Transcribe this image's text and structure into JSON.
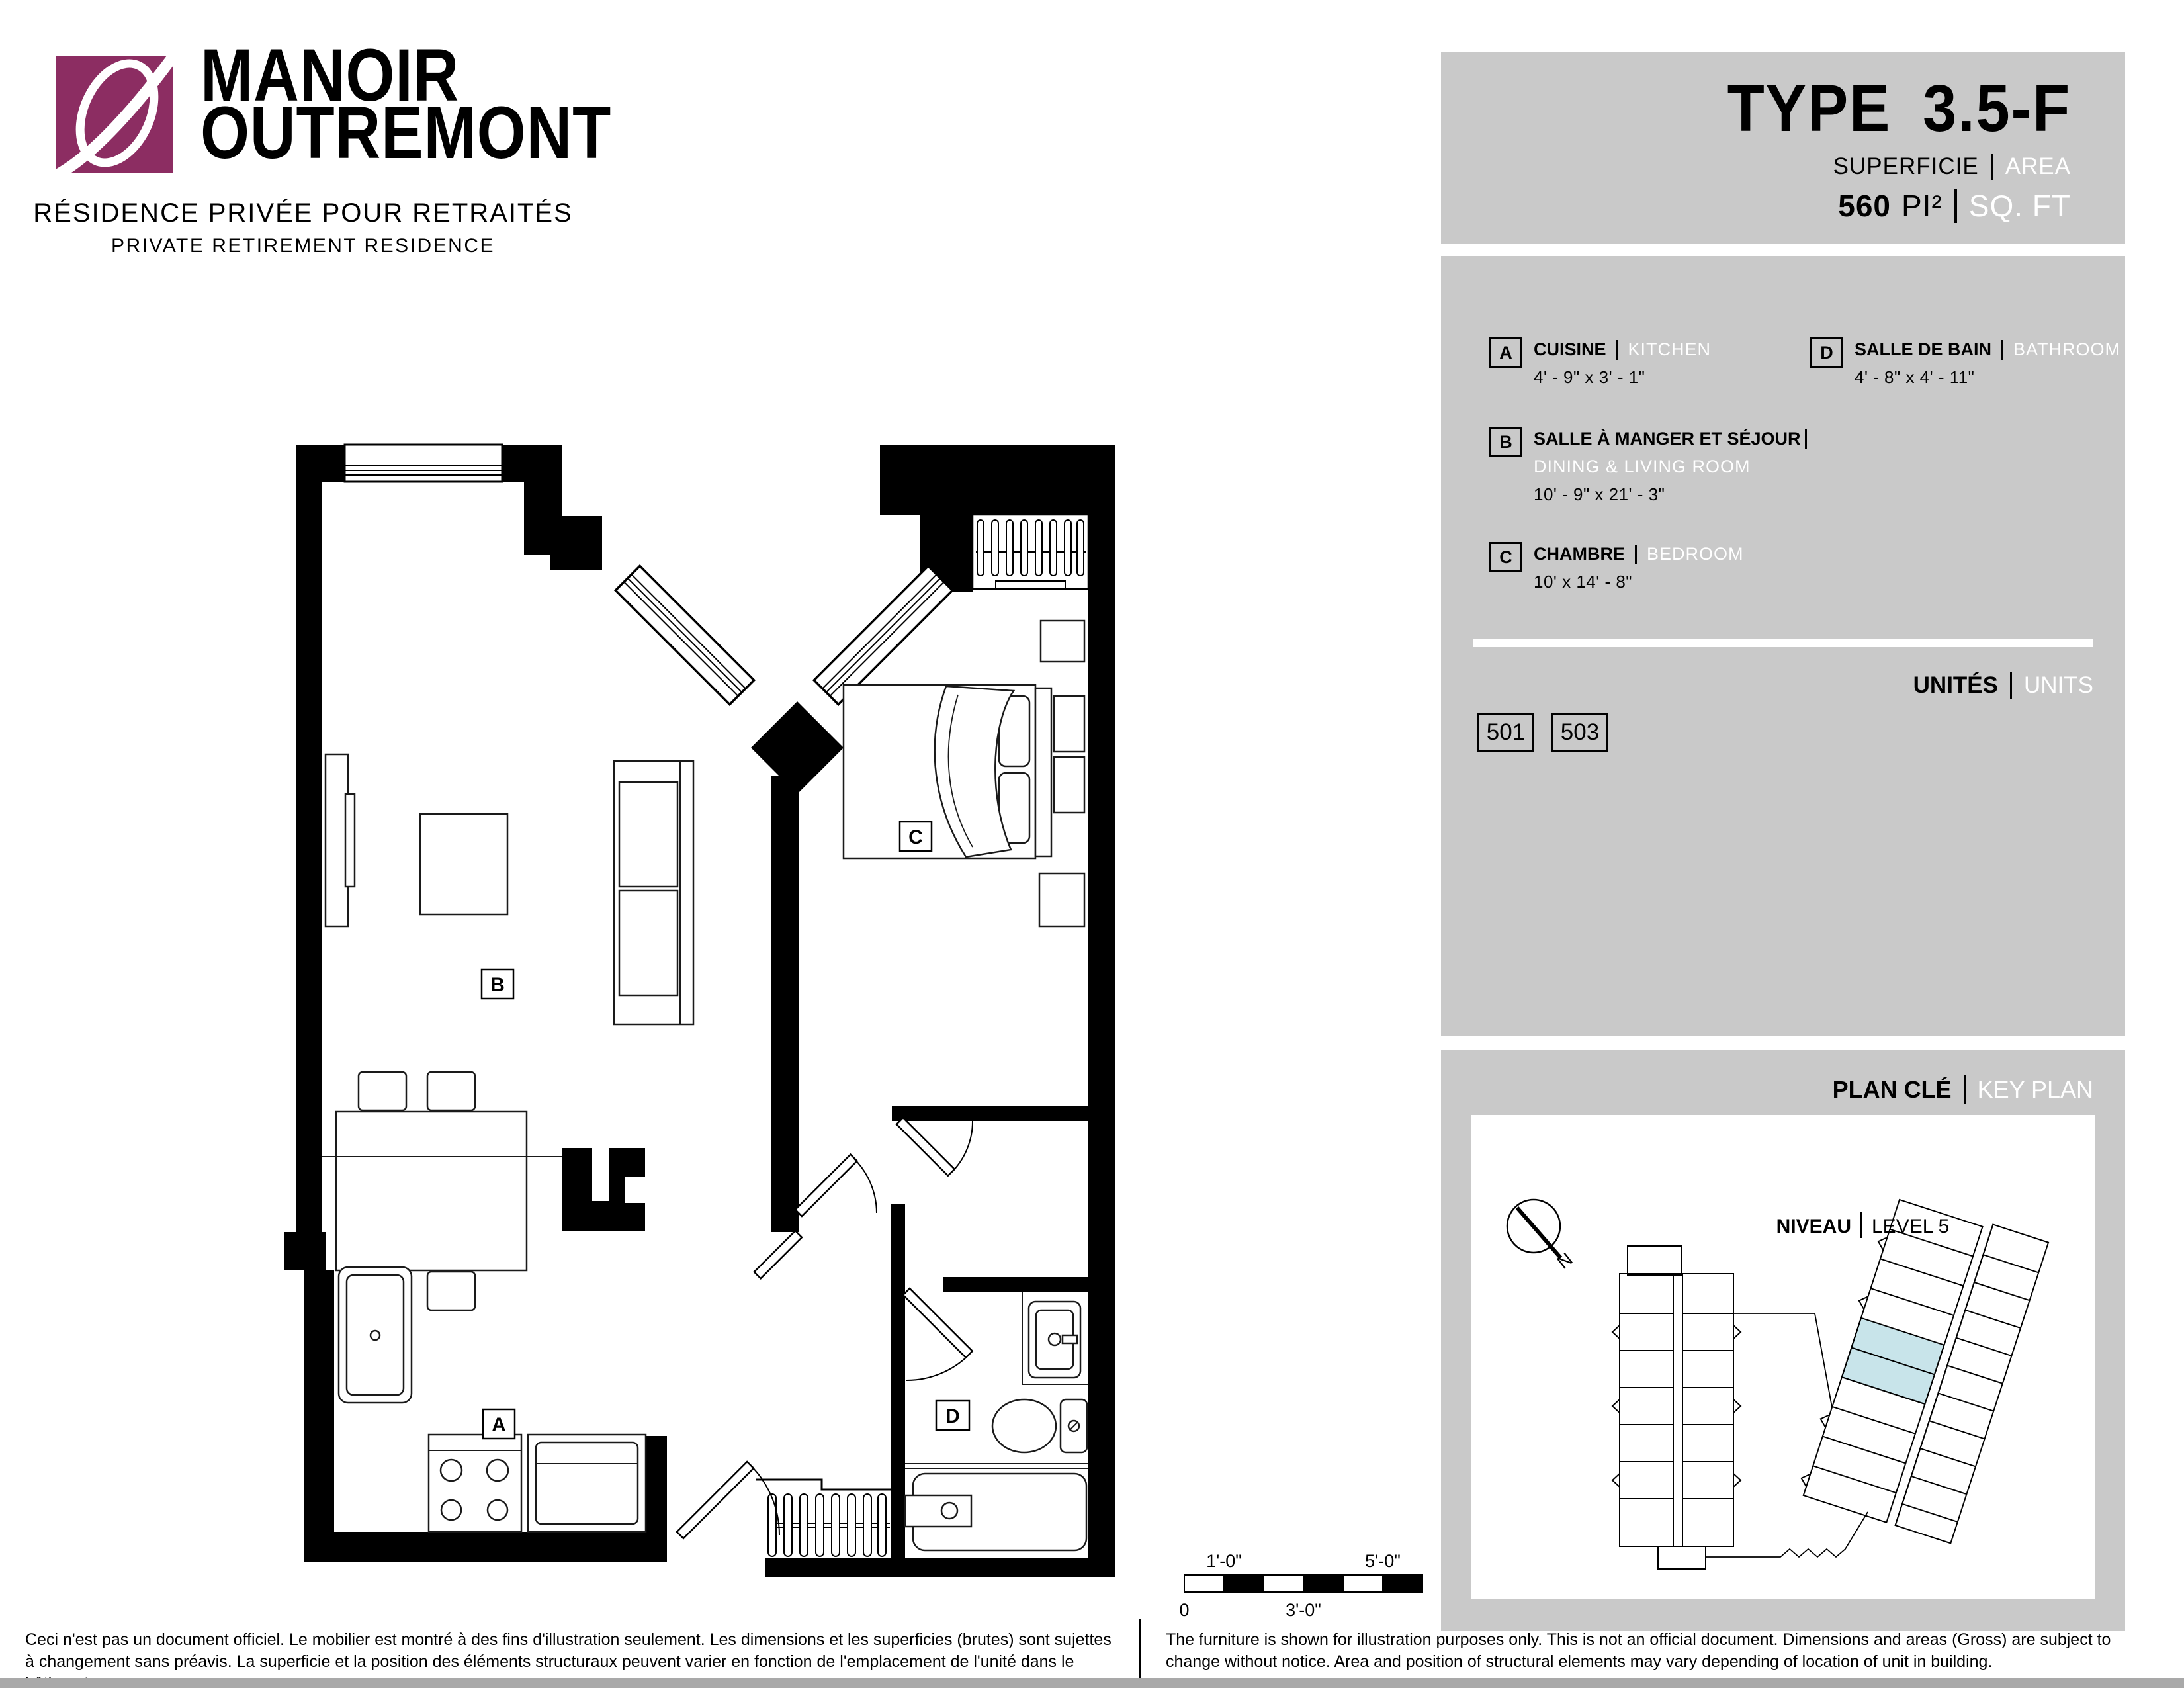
{
  "brand": {
    "title_line1": "MANOIR",
    "title_line2": "OUTREMONT",
    "subtitle_fr": "RÉSIDENCE PRIVÉE POUR RETRAITÉS",
    "subtitle_en": "PRIVATE RETIREMENT RESIDENCE"
  },
  "type_panel": {
    "label": "TYPE",
    "value": "3.5-F",
    "area_label_fr": "SUPERFICIE",
    "area_label_en": "AREA",
    "area_value": "560",
    "area_unit_fr": "PI²",
    "area_unit_en": "SQ. FT"
  },
  "legend": {
    "items": [
      {
        "key": "A",
        "name_fr": "CUISINE",
        "name_en": "KITCHEN",
        "dims": "4' - 9\" x 3' - 1\""
      },
      {
        "key": "B",
        "name_fr": "SALLE À MANGER  ET SÉJOUR",
        "name_en": "DINING & LIVING ROOM",
        "dims": "10' - 9\" x 21' - 3\""
      },
      {
        "key": "C",
        "name_fr": "CHAMBRE",
        "name_en": "BEDROOM",
        "dims": "10' x 14' - 8\""
      },
      {
        "key": "D",
        "name_fr": "SALLE DE BAIN",
        "name_en": "BATHROOM",
        "dims": "4' - 8\" x 4' - 11\""
      }
    ]
  },
  "units": {
    "label_fr": "UNITÉS",
    "label_en": "UNITS",
    "numbers": [
      "501",
      "503"
    ]
  },
  "key_plan": {
    "label_fr": "PLAN CLÉ",
    "label_en": "KEY PLAN",
    "level_label_fr": "NIVEAU",
    "level_label_en": "LEVEL 5",
    "north": "N",
    "highlight_color": "#C8E4EA"
  },
  "floor_plan": {
    "labels": {
      "kitchen": "A",
      "living": "B",
      "bedroom": "C",
      "bath": "D"
    }
  },
  "scale_bar": {
    "top_labels": [
      "1'-0\"",
      "5'-0\""
    ],
    "bottom_labels": [
      "0",
      "3'-0\""
    ]
  },
  "disclaimers": {
    "fr": "Ceci n'est pas un document officiel.  Le mobilier est montré à des fins d'illustration seulement.  Les dimensions et les superficies (brutes) sont sujettes à changement sans préavis. La superficie et la position des éléments structuraux peuvent varier en fonction de l'emplacement de l'unité dans le bâtiment.",
    "en": "The furniture is shown for illustration purposes only.  This is not an official document.  Dimensions and areas (Gross) are subject to change without notice.  Area and position of structural elements may vary depending of location of unit in building."
  },
  "colors": {
    "brand_purple": "#8C2D62",
    "panel_gray": "#C9C9C9",
    "highlight_blue": "#C8E4EA"
  }
}
